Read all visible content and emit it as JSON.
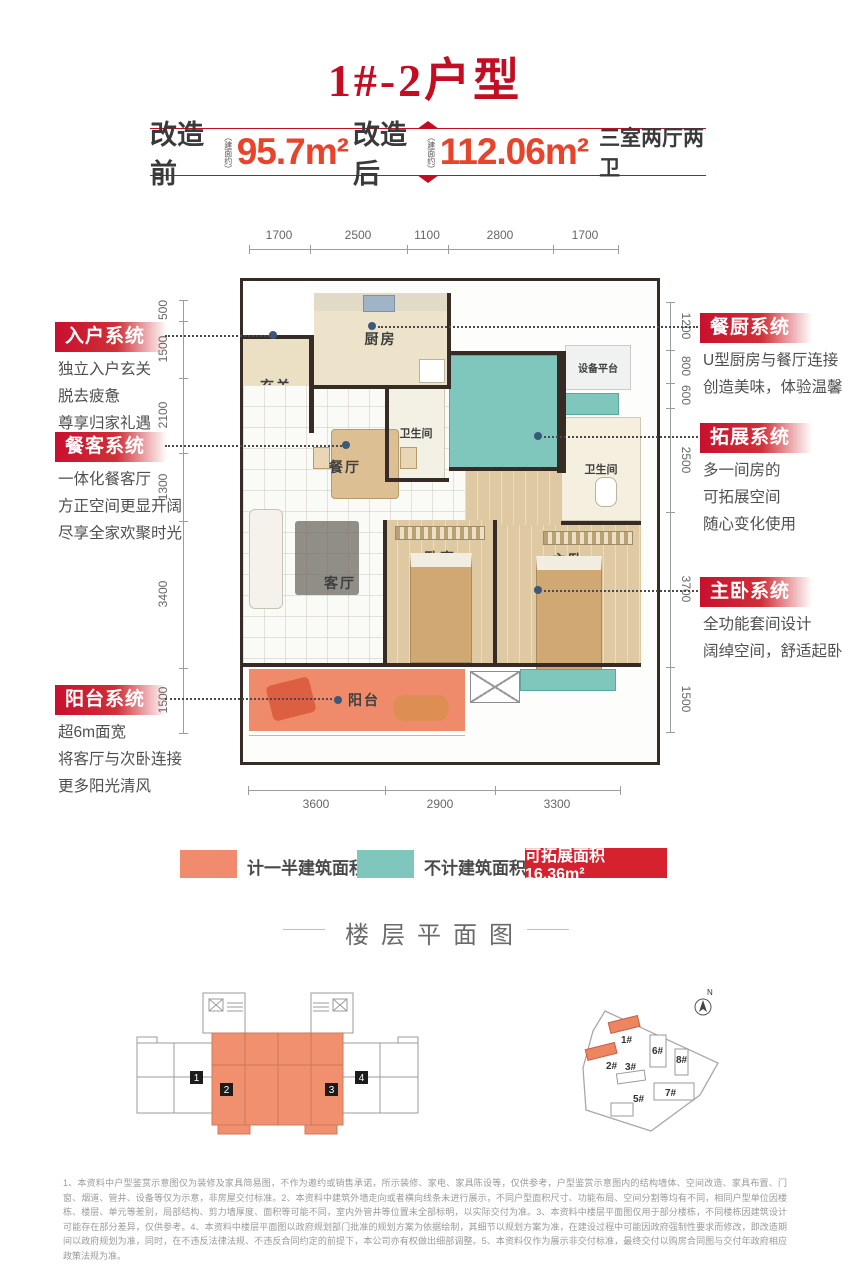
{
  "page": {
    "title": "1#-2户型"
  },
  "banner": {
    "before_label": "改造前",
    "area_note": "（建面约）",
    "before_value": "95.7m²",
    "after_label": "改造后",
    "after_value": "112.06m²",
    "layout_desc": "三室两厅两卫"
  },
  "dimensions": {
    "top": [
      "1700",
      "2500",
      "1100",
      "2800",
      "1700"
    ],
    "bottom": [
      "3600",
      "2900",
      "3300"
    ],
    "left": [
      "500",
      "1500",
      "2100",
      "1300",
      "3400",
      "1500"
    ],
    "right": [
      "1200",
      "800",
      "600",
      "2500",
      "3700",
      "1500"
    ]
  },
  "callouts": {
    "left": [
      {
        "title": "入户系统",
        "lines": [
          "独立入户玄关",
          "脱去疲惫",
          "尊享归家礼遇"
        ]
      },
      {
        "title": "餐客系统",
        "lines": [
          "一体化餐客厅",
          "方正空间更显开阔",
          "尽享全家欢聚时光"
        ]
      },
      {
        "title": "阳台系统",
        "lines": [
          "超6m面宽",
          "将客厅与次卧连接",
          "更多阳光清风"
        ]
      }
    ],
    "right": [
      {
        "title": "餐厨系统",
        "lines": [
          "U型厨房与餐厅连接",
          "创造美味，体验温馨"
        ]
      },
      {
        "title": "拓展系统",
        "lines": [
          "多一间房的",
          "可拓展空间",
          "随心变化使用"
        ]
      },
      {
        "title": "主卧系统",
        "lines": [
          "全功能套间设计",
          "阔绰空间，舒适起卧"
        ]
      }
    ]
  },
  "rooms": {
    "entry": "玄关",
    "kitchen": "厨房",
    "bath1": "卫生间",
    "dining": "餐厅",
    "living": "客厅",
    "bedroom": "卧室",
    "master": "主卧",
    "balcony": "阳台",
    "equipment": "设备平台",
    "bath2": "卫生间"
  },
  "legend": {
    "half_area": "计一半建筑面积",
    "not_counted": "不计建筑面积",
    "expandable": "可拓展面积 16.36m²"
  },
  "floor_section": {
    "title": "楼层平面图",
    "unit_badges": [
      "1",
      "2",
      "3",
      "4"
    ]
  },
  "site_map": {
    "compass": "N",
    "buildings": [
      "1#",
      "2#",
      "3#",
      "5#",
      "6#",
      "7#",
      "8#"
    ]
  },
  "colors": {
    "title_red": "#c30d23",
    "number_red": "#e8432b",
    "callout_red": "#c8102e",
    "orange": "#f08b6d",
    "teal": "#7fc6bd",
    "legend_red": "#d6212f",
    "wall": "#372b26"
  },
  "disclaimer": "1、本资料中户型鉴赏示意图仅为装修及家具简易图，不作为邀约或销售承诺，所示装修、家电、家具陈设等，仅供参考，户型鉴赏示意图内的结构墙体、空间改造、家具布置、门窗、烟道、管井、设备等仅为示意，非房屋交付标准。2、本资料中建筑外墙走向或者横向线条未进行展示，不同户型面积尺寸、功能布局、空间分割等均有不同，相同户型单位因楼栋、楼层、单元等差别，局部结构、剪力墙厚度、面积等可能不同，室内外管井等位置未全部标明，以实际交付为准。3、本资料中楼层平面图仅用于部分楼栋，不同楼栋因建筑设计可能存在部分差异，仅供参考。4、本资料中楼层平面图以政府规划部门批准的规划方案为依据绘制，其细节以规划方案为准，在建设过程中可能因政府强制性要求而修改，即改造期间以政府规划为准，同时，在不违反法律法规、不违反合同约定的前提下，本公司亦有权做出细部调整。5、本资料仅作为展示非交付标准，最终交付以购房合同图与交付年政府相应政策法规为准。"
}
